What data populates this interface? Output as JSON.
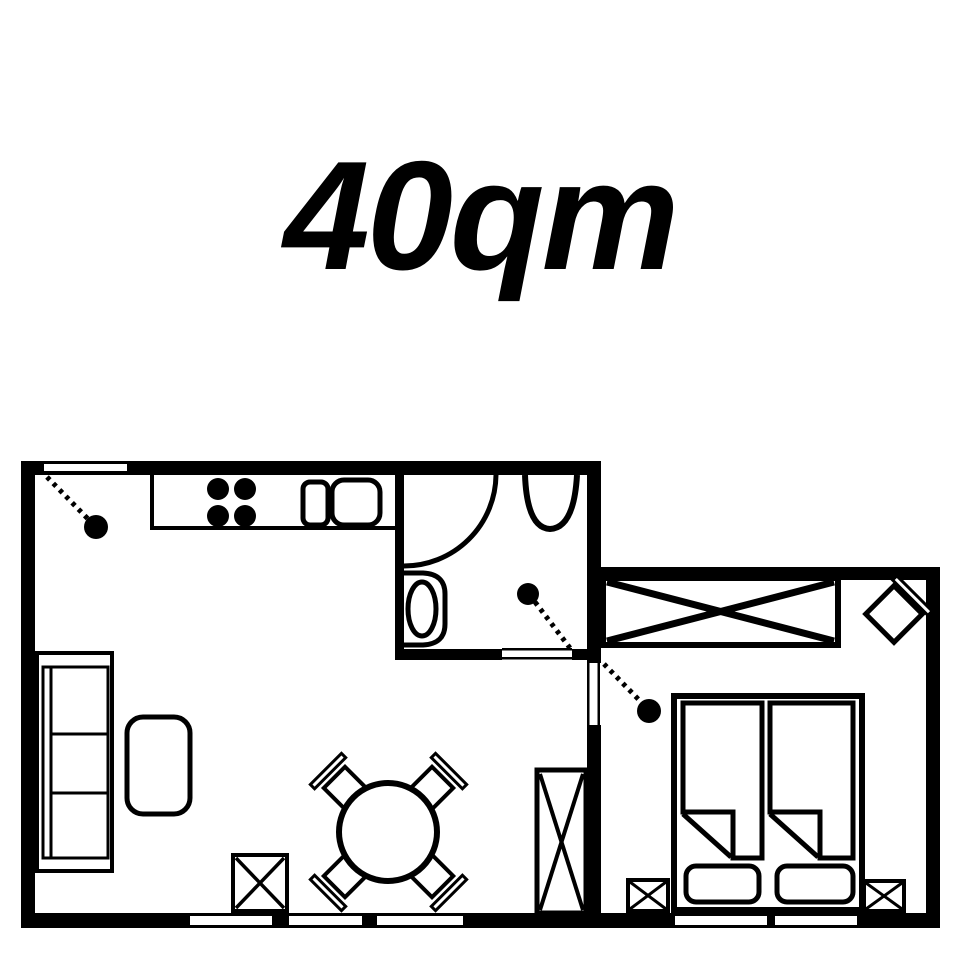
{
  "title": {
    "text": "40qm"
  },
  "colors": {
    "ink": "#000000",
    "paper": "#ffffff"
  },
  "plan": {
    "canvas": {
      "w": 960,
      "h": 960
    },
    "shapes": [
      {
        "name": "wall-top-left-block",
        "kind": "rect",
        "x": 21,
        "y": 461,
        "w": 580,
        "h": 14,
        "fill": "#000000"
      },
      {
        "name": "wall-left",
        "kind": "rect",
        "x": 21,
        "y": 461,
        "w": 14,
        "h": 467,
        "fill": "#000000"
      },
      {
        "name": "wall-bottom",
        "kind": "rect",
        "x": 21,
        "y": 913,
        "w": 919,
        "h": 15,
        "fill": "#000000"
      },
      {
        "name": "wall-bedroom-top",
        "kind": "rect",
        "x": 600,
        "y": 567,
        "w": 340,
        "h": 13,
        "fill": "#000000"
      },
      {
        "name": "wall-bedroom-right",
        "kind": "rect",
        "x": 926,
        "y": 567,
        "w": 14,
        "h": 361,
        "fill": "#000000"
      },
      {
        "name": "wall-divider-vertical",
        "kind": "rect",
        "x": 587,
        "y": 461,
        "w": 14,
        "h": 467,
        "fill": "#000000"
      },
      {
        "name": "wall-bathroom-left",
        "kind": "rect",
        "x": 395,
        "y": 461,
        "w": 9,
        "h": 199,
        "fill": "#000000"
      },
      {
        "name": "wall-bathroom-bottom",
        "kind": "rect",
        "x": 395,
        "y": 649,
        "w": 206,
        "h": 11,
        "fill": "#000000"
      },
      {
        "name": "entry-door-slab",
        "kind": "rect",
        "x": 44,
        "y": 464,
        "w": 83,
        "h": 7,
        "fill": "#ffffff"
      },
      {
        "name": "bathroom-door-gap",
        "kind": "rect",
        "x": 502,
        "y": 646,
        "w": 70,
        "h": 17,
        "fill": "#ffffff"
      },
      {
        "name": "bathroom-door-jamb-top",
        "kind": "rect",
        "x": 502,
        "y": 648,
        "w": 70,
        "h": 2.5,
        "fill": "#000000"
      },
      {
        "name": "bathroom-door-jamb-bottom",
        "kind": "rect",
        "x": 502,
        "y": 657,
        "w": 70,
        "h": 2.5,
        "fill": "#000000"
      },
      {
        "name": "bedroom-door-gap",
        "kind": "rect",
        "x": 585,
        "y": 663,
        "w": 18,
        "h": 62,
        "fill": "#ffffff"
      },
      {
        "name": "bedroom-door-jamb-left",
        "kind": "rect",
        "x": 587,
        "y": 663,
        "w": 2.5,
        "h": 62,
        "fill": "#000000"
      },
      {
        "name": "bedroom-door-jamb-right",
        "kind": "rect",
        "x": 597.5,
        "y": 663,
        "w": 2.5,
        "h": 62,
        "fill": "#000000"
      },
      {
        "name": "window-living-1",
        "kind": "rect",
        "x": 190,
        "y": 916,
        "w": 82,
        "h": 9,
        "fill": "#ffffff"
      },
      {
        "name": "window-living-2",
        "kind": "rect",
        "x": 289,
        "y": 916,
        "w": 73,
        "h": 9,
        "fill": "#ffffff"
      },
      {
        "name": "window-living-3",
        "kind": "rect",
        "x": 377,
        "y": 916,
        "w": 86,
        "h": 9,
        "fill": "#ffffff"
      },
      {
        "name": "window-bedroom-1",
        "kind": "rect",
        "x": 675,
        "y": 916,
        "w": 92,
        "h": 9,
        "fill": "#ffffff"
      },
      {
        "name": "window-bedroom-2",
        "kind": "rect",
        "x": 775,
        "y": 916,
        "w": 82,
        "h": 9,
        "fill": "#ffffff"
      },
      {
        "name": "kitchen-counter-left-edge",
        "kind": "line",
        "x1": 152,
        "y1": 475,
        "x2": 152,
        "y2": 530,
        "sw": 4
      },
      {
        "name": "kitchen-counter-front-edge",
        "kind": "line",
        "x1": 150,
        "y1": 528,
        "x2": 395,
        "y2": 528,
        "sw": 4
      },
      {
        "name": "stove-burner-1",
        "kind": "circle",
        "cx": 218,
        "cy": 489,
        "r": 11,
        "fill": "#000000"
      },
      {
        "name": "stove-burner-2",
        "kind": "circle",
        "cx": 245,
        "cy": 489,
        "r": 11,
        "fill": "#000000"
      },
      {
        "name": "stove-burner-3",
        "kind": "circle",
        "cx": 218,
        "cy": 516,
        "r": 11,
        "fill": "#000000"
      },
      {
        "name": "stove-burner-4",
        "kind": "circle",
        "cx": 245,
        "cy": 516,
        "r": 11,
        "fill": "#000000"
      },
      {
        "name": "sink-basin-small",
        "kind": "rect",
        "x": 303,
        "y": 482,
        "w": 25,
        "h": 43,
        "rx": 7,
        "sw": 5
      },
      {
        "name": "sink-basin-large",
        "kind": "rect",
        "x": 332,
        "y": 480,
        "w": 48,
        "h": 45,
        "rx": 12,
        "sw": 5
      },
      {
        "name": "entry-door-swing-line",
        "kind": "line",
        "x1": 47,
        "y1": 477,
        "x2": 89,
        "y2": 520,
        "sw": 5,
        "dash": "4 5"
      },
      {
        "name": "entry-door-knob",
        "kind": "circle",
        "cx": 96,
        "cy": 527,
        "r": 12,
        "fill": "#000000"
      },
      {
        "name": "bathroom-door-swing-arc",
        "kind": "path",
        "d": "M 496 475 A 92 92 0 0 1 404 566",
        "sw": 5
      },
      {
        "name": "washbasin",
        "kind": "path",
        "d": "M 525 475 Q 527 528 550 529 Q 574 528 577 475",
        "sw": 6
      },
      {
        "name": "toilet-outline",
        "kind": "path",
        "d": "M 403 573 H 423 Q 445 574 445 594 V 624 Q 445 644 423 645 H 403",
        "sw": 5
      },
      {
        "name": "toilet-bowl",
        "kind": "ellipse",
        "cx": 422,
        "cy": 609,
        "rx": 14,
        "ry": 27,
        "sw": 5
      },
      {
        "name": "bathroom-door-knob",
        "kind": "circle",
        "cx": 528,
        "cy": 594,
        "r": 11,
        "fill": "#000000"
      },
      {
        "name": "bathroom-door-swing-line",
        "kind": "line",
        "x1": 535,
        "y1": 602,
        "x2": 570,
        "y2": 648,
        "sw": 5,
        "dash": "4 5"
      },
      {
        "name": "bedroom-door-swing-line",
        "kind": "line",
        "x1": 604,
        "y1": 664,
        "x2": 642,
        "y2": 703,
        "sw": 5,
        "dash": "4 5"
      },
      {
        "name": "bedroom-door-knob",
        "kind": "circle",
        "cx": 649,
        "cy": 711,
        "r": 12,
        "fill": "#000000"
      },
      {
        "name": "wardrobe-body",
        "kind": "rect",
        "x": 603,
        "y": 578,
        "w": 235,
        "h": 67,
        "sw": 6
      },
      {
        "name": "wardrobe-cross-1",
        "kind": "line",
        "x1": 607,
        "y1": 582,
        "x2": 834,
        "y2": 641,
        "sw": 7
      },
      {
        "name": "wardrobe-cross-2",
        "kind": "line",
        "x1": 834,
        "y1": 582,
        "x2": 607,
        "y2": 641,
        "sw": 7
      },
      {
        "name": "corner-chair-backrest",
        "kind": "rect",
        "x": -25,
        "y": -29,
        "w": 50,
        "h": 6,
        "sw": 3,
        "fill": "#ffffff",
        "tf": "translate(894,614) rotate(45)"
      },
      {
        "name": "corner-chair-seat",
        "kind": "rect",
        "x": -20,
        "y": -20,
        "w": 40,
        "h": 40,
        "sw": 5,
        "fill": "#ffffff",
        "tf": "translate(894,614) rotate(45)"
      },
      {
        "name": "bed-frame",
        "kind": "rect",
        "x": 674,
        "y": 696,
        "w": 188,
        "h": 214,
        "sw": 6
      },
      {
        "name": "duvet-left",
        "kind": "path",
        "d": "M 683 703 H 762 V 858 H 733 V 812 H 683 Z",
        "sw": 5,
        "fill": "#ffffff"
      },
      {
        "name": "duvet-left-fold",
        "kind": "line",
        "x1": 683,
        "y1": 814,
        "x2": 731,
        "y2": 857,
        "sw": 5
      },
      {
        "name": "duvet-right",
        "kind": "path",
        "d": "M 770 703 H 853 V 858 H 820 V 812 H 770 Z",
        "sw": 5,
        "fill": "#ffffff"
      },
      {
        "name": "duvet-right-fold",
        "kind": "line",
        "x1": 770,
        "y1": 814,
        "x2": 818,
        "y2": 857,
        "sw": 5
      },
      {
        "name": "pillow-left",
        "kind": "rect",
        "x": 686,
        "y": 866,
        "w": 73,
        "h": 36,
        "rx": 10,
        "sw": 5,
        "fill": "#ffffff"
      },
      {
        "name": "pillow-right",
        "kind": "rect",
        "x": 777,
        "y": 866,
        "w": 76,
        "h": 36,
        "rx": 10,
        "sw": 5,
        "fill": "#ffffff"
      },
      {
        "name": "nightstand-left",
        "kind": "rect",
        "x": 628,
        "y": 880,
        "w": 40,
        "h": 31,
        "sw": 4,
        "fill": "#ffffff"
      },
      {
        "name": "nightstand-left-cross-1",
        "kind": "line",
        "x1": 630,
        "y1": 882,
        "x2": 666,
        "y2": 909,
        "sw": 3
      },
      {
        "name": "nightstand-left-cross-2",
        "kind": "line",
        "x1": 666,
        "y1": 882,
        "x2": 630,
        "y2": 909,
        "sw": 3
      },
      {
        "name": "nightstand-right",
        "kind": "rect",
        "x": 864,
        "y": 881,
        "w": 40,
        "h": 30,
        "sw": 4,
        "fill": "#ffffff"
      },
      {
        "name": "nightstand-right-cross-1",
        "kind": "line",
        "x1": 866,
        "y1": 883,
        "x2": 902,
        "y2": 909,
        "sw": 3
      },
      {
        "name": "nightstand-right-cross-2",
        "kind": "line",
        "x1": 902,
        "y1": 883,
        "x2": 866,
        "y2": 909,
        "sw": 3
      },
      {
        "name": "sofa-outline",
        "kind": "rect",
        "x": 37,
        "y": 653,
        "w": 75,
        "h": 218,
        "sw": 4
      },
      {
        "name": "sofa-inner",
        "kind": "rect",
        "x": 43,
        "y": 667,
        "w": 65,
        "h": 191,
        "sw": 3
      },
      {
        "name": "sofa-backrest-edge",
        "kind": "line",
        "x1": 51,
        "y1": 667,
        "x2": 51,
        "y2": 858,
        "sw": 3
      },
      {
        "name": "sofa-cushion-divider-1",
        "kind": "line",
        "x1": 51,
        "y1": 734,
        "x2": 108,
        "y2": 734,
        "sw": 3
      },
      {
        "name": "sofa-cushion-divider-2",
        "kind": "line",
        "x1": 51,
        "y1": 793,
        "x2": 108,
        "y2": 793,
        "sw": 3
      },
      {
        "name": "coffee-table",
        "kind": "rect",
        "x": 127,
        "y": 717,
        "w": 63,
        "h": 97,
        "rx": 16,
        "sw": 5
      },
      {
        "name": "dining-chair-nw-backrest",
        "kind": "rect",
        "x": -22,
        "y": -27,
        "w": 44,
        "h": 6,
        "sw": 3,
        "fill": "#ffffff",
        "tf": "translate(345,788) rotate(-45)"
      },
      {
        "name": "dining-chair-nw-seat",
        "kind": "rect",
        "x": -15,
        "y": -15,
        "w": 30,
        "h": 30,
        "sw": 4,
        "fill": "#ffffff",
        "tf": "translate(345,788) rotate(-45)"
      },
      {
        "name": "dining-chair-ne-backrest",
        "kind": "rect",
        "x": -22,
        "y": -27,
        "w": 44,
        "h": 6,
        "sw": 3,
        "fill": "#ffffff",
        "tf": "translate(432,788) rotate(45)"
      },
      {
        "name": "dining-chair-ne-seat",
        "kind": "rect",
        "x": -15,
        "y": -15,
        "w": 30,
        "h": 30,
        "sw": 4,
        "fill": "#ffffff",
        "tf": "translate(432,788) rotate(45)"
      },
      {
        "name": "dining-chair-sw-backrest",
        "kind": "rect",
        "x": -22,
        "y": -27,
        "w": 44,
        "h": 6,
        "sw": 3,
        "fill": "#ffffff",
        "tf": "translate(345,876) rotate(-135)"
      },
      {
        "name": "dining-chair-sw-seat",
        "kind": "rect",
        "x": -15,
        "y": -15,
        "w": 30,
        "h": 30,
        "sw": 4,
        "fill": "#ffffff",
        "tf": "translate(345,876) rotate(-135)"
      },
      {
        "name": "dining-chair-se-backrest",
        "kind": "rect",
        "x": -22,
        "y": -27,
        "w": 44,
        "h": 6,
        "sw": 3,
        "fill": "#ffffff",
        "tf": "translate(432,876) rotate(135)"
      },
      {
        "name": "dining-chair-se-seat",
        "kind": "rect",
        "x": -15,
        "y": -15,
        "w": 30,
        "h": 30,
        "sw": 4,
        "fill": "#ffffff",
        "tf": "translate(432,876) rotate(135)"
      },
      {
        "name": "dining-table",
        "kind": "circle",
        "cx": 388,
        "cy": 832,
        "r": 49,
        "sw": 6,
        "fill": "#ffffff"
      },
      {
        "name": "side-table",
        "kind": "rect",
        "x": 233,
        "y": 855,
        "w": 54,
        "h": 56,
        "sw": 4,
        "fill": "#ffffff"
      },
      {
        "name": "side-table-cross-1",
        "kind": "line",
        "x1": 236,
        "y1": 858,
        "x2": 284,
        "y2": 908,
        "sw": 3.5
      },
      {
        "name": "side-table-cross-2",
        "kind": "line",
        "x1": 284,
        "y1": 858,
        "x2": 236,
        "y2": 908,
        "sw": 3.5
      },
      {
        "name": "tall-cabinet",
        "kind": "rect",
        "x": 537,
        "y": 770,
        "w": 49,
        "h": 143,
        "sw": 5,
        "fill": "#ffffff"
      },
      {
        "name": "tall-cabinet-cross-1",
        "kind": "line",
        "x1": 540,
        "y1": 774,
        "x2": 583,
        "y2": 910,
        "sw": 4
      },
      {
        "name": "tall-cabinet-cross-2",
        "kind": "line",
        "x1": 583,
        "y1": 774,
        "x2": 540,
        "y2": 910,
        "sw": 4
      }
    ]
  }
}
